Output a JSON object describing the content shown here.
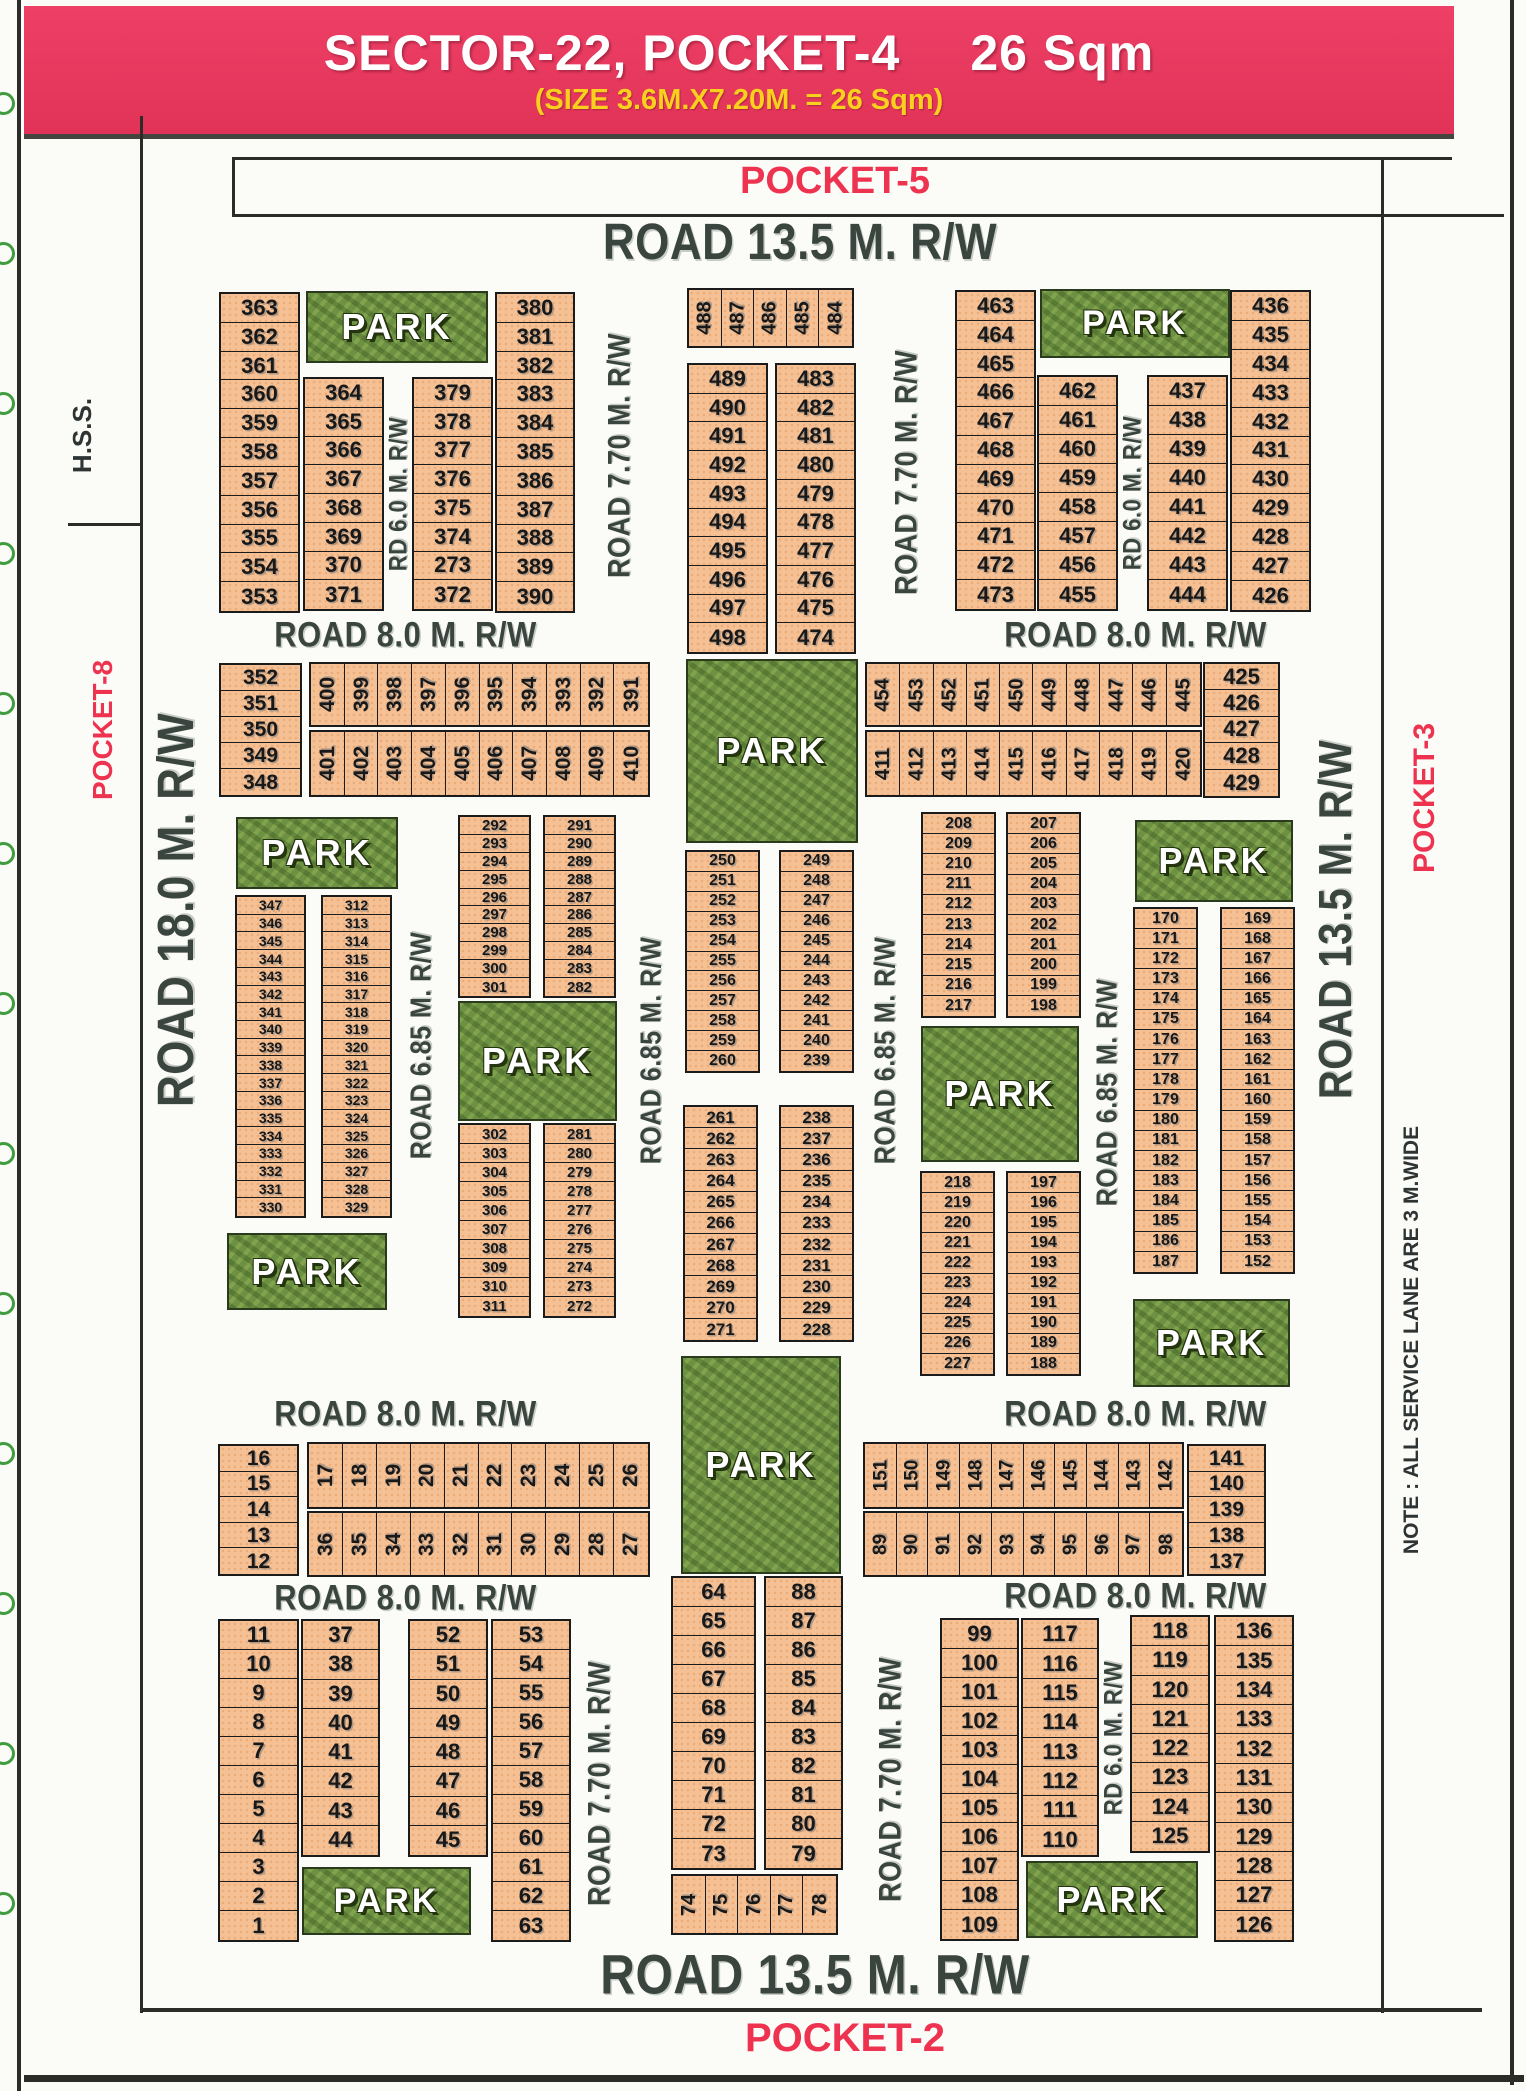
{
  "header": {
    "title_main": "SECTOR-22, POCKET-4",
    "title_area": "26 Sqm",
    "subtitle": "(SIZE 3.6M.X7.20M. = 26 Sqm)"
  },
  "pocket_top": "POCKET-5",
  "pocket_bottom": "POCKET-2",
  "pocket_left": "POCKET-8",
  "pocket_right": "POCKET-3",
  "hss": "H.S.S.",
  "note": "NOTE : ALL SERVICE LANE ARE 3 M.WIDE",
  "park_label": "PARK",
  "colors": {
    "banner": "#e73a5e",
    "banner_text": "#ffffff",
    "subtitle_yellow": "#f8d01d",
    "plot_fill": "#f5c094",
    "park_green": "#6d9142",
    "road_text": "#3a4540",
    "pocket_red": "#ee3350",
    "line_dark": "#2b2b28"
  },
  "binding": {
    "count": 13,
    "start_y": 92,
    "gap": 150
  },
  "road_labels": [
    {
      "text": "ROAD 13.5 M. R/W",
      "x": 540,
      "y": 218,
      "w": 520,
      "h": 50,
      "o": "h",
      "s": 44
    },
    {
      "text": "ROAD 8.0 M. R/W",
      "x": 238,
      "y": 614,
      "w": 335,
      "h": 42,
      "o": "h",
      "s": 31
    },
    {
      "text": "ROAD 8.0 M. R/W",
      "x": 968,
      "y": 614,
      "w": 335,
      "h": 42,
      "o": "h",
      "s": 31
    },
    {
      "text": "ROAD 8.0 M. R/W",
      "x": 238,
      "y": 1394,
      "w": 335,
      "h": 40,
      "o": "h",
      "s": 31
    },
    {
      "text": "ROAD 8.0 M. R/W",
      "x": 968,
      "y": 1394,
      "w": 335,
      "h": 40,
      "o": "h",
      "s": 31
    },
    {
      "text": "ROAD 8.0 M. R/W",
      "x": 238,
      "y": 1578,
      "w": 335,
      "h": 40,
      "o": "h",
      "s": 31
    },
    {
      "text": "ROAD 8.0 M. R/W",
      "x": 968,
      "y": 1576,
      "w": 335,
      "h": 40,
      "o": "h",
      "s": 31
    },
    {
      "text": "ROAD 13.5 M. R/W",
      "x": 530,
      "y": 1944,
      "w": 570,
      "h": 62,
      "o": "h",
      "s": 48
    },
    {
      "text": "ROAD 7.70 M. R/W",
      "x": 597,
      "y": 288,
      "w": 45,
      "h": 335,
      "o": "v",
      "s": 27
    },
    {
      "text": "ROAD 7.70 M. R/W",
      "x": 884,
      "y": 288,
      "w": 45,
      "h": 368,
      "o": "v",
      "s": 27
    },
    {
      "text": "RD 6.0 M. R/W",
      "x": 383,
      "y": 377,
      "w": 30,
      "h": 233,
      "o": "v",
      "s": 22
    },
    {
      "text": "RD 6.0 M. R/W",
      "x": 1117,
      "y": 375,
      "w": 30,
      "h": 236,
      "o": "v",
      "s": 22
    },
    {
      "text": "ROAD 18.0 M. R/W",
      "x": 148,
      "y": 550,
      "w": 58,
      "h": 720,
      "o": "v",
      "s": 44
    },
    {
      "text": "ROAD 6.85 M. R/W",
      "x": 400,
      "y": 893,
      "w": 44,
      "h": 305,
      "o": "v",
      "s": 25
    },
    {
      "text": "ROAD 6.85 M. R/W",
      "x": 630,
      "y": 893,
      "w": 44,
      "h": 315,
      "o": "v",
      "s": 25
    },
    {
      "text": "ROAD 6.85 M. R/W",
      "x": 864,
      "y": 893,
      "w": 44,
      "h": 315,
      "o": "v",
      "s": 25
    },
    {
      "text": "ROAD 6.85 M. R/W",
      "x": 1086,
      "y": 940,
      "w": 44,
      "h": 305,
      "o": "v",
      "s": 25
    },
    {
      "text": "ROAD 13.5 M. R/W",
      "x": 1310,
      "y": 672,
      "w": 54,
      "h": 495,
      "o": "v",
      "s": 40
    },
    {
      "text": "ROAD 7.70 M. R/W",
      "x": 577,
      "y": 1630,
      "w": 45,
      "h": 307,
      "o": "v",
      "s": 27
    },
    {
      "text": "ROAD 7.70 M. R/W",
      "x": 868,
      "y": 1626,
      "w": 45,
      "h": 307,
      "o": "v",
      "s": 27
    },
    {
      "text": "RD 6.0 M. R/W",
      "x": 1099,
      "y": 1619,
      "w": 28,
      "h": 238,
      "o": "v",
      "s": 22
    }
  ],
  "plot_blocks": [
    {
      "x": 219,
      "y": 292,
      "w": 81,
      "h": 321,
      "o": "v",
      "plots": [
        363,
        362,
        361,
        360,
        359,
        358,
        357,
        356,
        355,
        354,
        353
      ]
    },
    {
      "x": 303,
      "y": 377,
      "w": 81,
      "h": 234,
      "o": "v",
      "plots": [
        364,
        365,
        366,
        367,
        368,
        369,
        370,
        371
      ]
    },
    {
      "x": 412,
      "y": 377,
      "w": 81,
      "h": 234,
      "o": "v",
      "plots": [
        379,
        378,
        377,
        376,
        375,
        374,
        273,
        372
      ]
    },
    {
      "x": 495,
      "y": 292,
      "w": 80,
      "h": 321,
      "o": "v",
      "plots": [
        380,
        381,
        382,
        383,
        384,
        385,
        386,
        387,
        388,
        389,
        390
      ]
    },
    {
      "x": 687,
      "y": 288,
      "w": 167,
      "h": 60,
      "o": "h",
      "plots": [
        488,
        487,
        486,
        485,
        484
      ]
    },
    {
      "x": 687,
      "y": 363,
      "w": 81,
      "h": 291,
      "o": "v",
      "plots": [
        489,
        490,
        491,
        492,
        493,
        494,
        495,
        496,
        497,
        498
      ]
    },
    {
      "x": 775,
      "y": 363,
      "w": 81,
      "h": 291,
      "o": "v",
      "plots": [
        483,
        482,
        481,
        480,
        479,
        478,
        477,
        476,
        475,
        474
      ]
    },
    {
      "x": 955,
      "y": 290,
      "w": 81,
      "h": 321,
      "o": "v",
      "plots": [
        463,
        464,
        465,
        466,
        467,
        468,
        469,
        470,
        471,
        472,
        473
      ]
    },
    {
      "x": 1037,
      "y": 375,
      "w": 81,
      "h": 236,
      "o": "v",
      "plots": [
        462,
        461,
        460,
        459,
        458,
        457,
        456,
        455
      ]
    },
    {
      "x": 1147,
      "y": 375,
      "w": 81,
      "h": 236,
      "o": "v",
      "plots": [
        437,
        438,
        439,
        440,
        441,
        442,
        443,
        444
      ]
    },
    {
      "x": 1230,
      "y": 290,
      "w": 81,
      "h": 322,
      "o": "v",
      "plots": [
        436,
        435,
        434,
        433,
        432,
        431,
        430,
        429,
        428,
        427,
        426
      ]
    },
    {
      "x": 219,
      "y": 663,
      "w": 83,
      "h": 134,
      "o": "v",
      "plots": [
        352,
        351,
        350,
        349,
        348
      ]
    },
    {
      "x": 309,
      "y": 662,
      "w": 341,
      "h": 65,
      "o": "h",
      "plots": [
        400,
        399,
        398,
        397,
        396,
        395,
        394,
        393,
        392,
        391
      ]
    },
    {
      "x": 309,
      "y": 730,
      "w": 341,
      "h": 67,
      "o": "h",
      "plots": [
        401,
        402,
        403,
        404,
        405,
        406,
        407,
        408,
        409,
        410
      ]
    },
    {
      "x": 865,
      "y": 662,
      "w": 337,
      "h": 65,
      "o": "h",
      "plots": [
        454,
        453,
        452,
        451,
        450,
        449,
        448,
        447,
        446,
        445
      ]
    },
    {
      "x": 865,
      "y": 730,
      "w": 337,
      "h": 67,
      "o": "h",
      "plots": [
        411,
        412,
        413,
        414,
        415,
        416,
        417,
        418,
        419,
        420
      ]
    },
    {
      "x": 1203,
      "y": 662,
      "w": 77,
      "h": 136,
      "o": "v",
      "plots": [
        425,
        426,
        427,
        428,
        429
      ]
    },
    {
      "x": 235,
      "y": 895,
      "w": 71,
      "h": 323,
      "o": "v",
      "plots": [
        347,
        346,
        345,
        344,
        343,
        342,
        341,
        340,
        339,
        338,
        337,
        336,
        335,
        334,
        333,
        332,
        331,
        330
      ]
    },
    {
      "x": 321,
      "y": 895,
      "w": 71,
      "h": 323,
      "o": "v",
      "plots": [
        312,
        313,
        314,
        315,
        316,
        317,
        318,
        319,
        320,
        321,
        322,
        323,
        324,
        325,
        326,
        327,
        328,
        329
      ]
    },
    {
      "x": 458,
      "y": 815,
      "w": 73,
      "h": 183,
      "o": "v",
      "plots": [
        292,
        293,
        294,
        295,
        296,
        297,
        298,
        299,
        300,
        301
      ]
    },
    {
      "x": 543,
      "y": 815,
      "w": 73,
      "h": 183,
      "o": "v",
      "plots": [
        291,
        290,
        289,
        288,
        287,
        286,
        285,
        284,
        283,
        282
      ]
    },
    {
      "x": 458,
      "y": 1123,
      "w": 73,
      "h": 195,
      "o": "v",
      "plots": [
        302,
        303,
        304,
        305,
        306,
        307,
        308,
        309,
        310,
        311
      ]
    },
    {
      "x": 543,
      "y": 1123,
      "w": 73,
      "h": 195,
      "o": "v",
      "plots": [
        281,
        280,
        279,
        278,
        277,
        276,
        275,
        274,
        273,
        272
      ]
    },
    {
      "x": 685,
      "y": 850,
      "w": 75,
      "h": 223,
      "o": "v",
      "plots": [
        250,
        251,
        252,
        253,
        254,
        255,
        256,
        257,
        258,
        259,
        260
      ]
    },
    {
      "x": 779,
      "y": 850,
      "w": 75,
      "h": 223,
      "o": "v",
      "plots": [
        249,
        248,
        247,
        246,
        245,
        244,
        243,
        242,
        241,
        240,
        239
      ]
    },
    {
      "x": 683,
      "y": 1105,
      "w": 75,
      "h": 237,
      "o": "v",
      "plots": [
        261,
        262,
        263,
        264,
        265,
        266,
        267,
        268,
        269,
        270,
        271
      ]
    },
    {
      "x": 779,
      "y": 1105,
      "w": 75,
      "h": 237,
      "o": "v",
      "plots": [
        238,
        237,
        236,
        235,
        234,
        233,
        232,
        231,
        230,
        229,
        228
      ]
    },
    {
      "x": 921,
      "y": 812,
      "w": 75,
      "h": 206,
      "o": "v",
      "plots": [
        208,
        209,
        210,
        211,
        212,
        213,
        214,
        215,
        216,
        217
      ]
    },
    {
      "x": 1006,
      "y": 812,
      "w": 75,
      "h": 206,
      "o": "v",
      "plots": [
        207,
        206,
        205,
        204,
        203,
        202,
        201,
        200,
        199,
        198
      ]
    },
    {
      "x": 920,
      "y": 1171,
      "w": 75,
      "h": 205,
      "o": "v",
      "plots": [
        218,
        219,
        220,
        221,
        222,
        223,
        224,
        225,
        226,
        227
      ]
    },
    {
      "x": 1006,
      "y": 1171,
      "w": 75,
      "h": 205,
      "o": "v",
      "plots": [
        197,
        196,
        195,
        194,
        193,
        192,
        191,
        190,
        189,
        188
      ]
    },
    {
      "x": 1133,
      "y": 907,
      "w": 65,
      "h": 367,
      "o": "v",
      "plots": [
        170,
        171,
        172,
        173,
        174,
        175,
        176,
        177,
        178,
        179,
        180,
        181,
        182,
        183,
        184,
        185,
        186,
        187
      ]
    },
    {
      "x": 1220,
      "y": 907,
      "w": 75,
      "h": 367,
      "o": "v",
      "plots": [
        169,
        168,
        167,
        166,
        165,
        164,
        163,
        162,
        161,
        160,
        159,
        158,
        157,
        156,
        155,
        154,
        153,
        152
      ]
    },
    {
      "x": 218,
      "y": 1444,
      "w": 81,
      "h": 132,
      "o": "v",
      "plots": [
        16,
        15,
        14,
        13,
        12
      ]
    },
    {
      "x": 307,
      "y": 1442,
      "w": 343,
      "h": 67,
      "o": "h",
      "plots": [
        17,
        18,
        19,
        20,
        21,
        22,
        23,
        24,
        25,
        26
      ]
    },
    {
      "x": 307,
      "y": 1511,
      "w": 343,
      "h": 66,
      "o": "h",
      "plots": [
        36,
        35,
        34,
        33,
        32,
        31,
        30,
        29,
        28,
        27
      ]
    },
    {
      "x": 863,
      "y": 1442,
      "w": 321,
      "h": 67,
      "o": "h",
      "plots": [
        151,
        150,
        149,
        148,
        147,
        146,
        145,
        144,
        143,
        142
      ]
    },
    {
      "x": 863,
      "y": 1511,
      "w": 321,
      "h": 66,
      "o": "h",
      "plots": [
        89,
        90,
        91,
        92,
        93,
        94,
        95,
        96,
        97,
        98
      ]
    },
    {
      "x": 1187,
      "y": 1444,
      "w": 79,
      "h": 132,
      "o": "v",
      "plots": [
        141,
        140,
        139,
        138,
        137
      ]
    },
    {
      "x": 218,
      "y": 1619,
      "w": 81,
      "h": 323,
      "o": "v",
      "plots": [
        11,
        10,
        9,
        8,
        7,
        6,
        5,
        4,
        3,
        2,
        1
      ]
    },
    {
      "x": 301,
      "y": 1619,
      "w": 79,
      "h": 238,
      "o": "v",
      "plots": [
        37,
        38,
        39,
        40,
        41,
        42,
        43,
        44
      ]
    },
    {
      "x": 408,
      "y": 1619,
      "w": 80,
      "h": 238,
      "o": "v",
      "plots": [
        52,
        51,
        50,
        49,
        48,
        47,
        46,
        45
      ]
    },
    {
      "x": 491,
      "y": 1619,
      "w": 80,
      "h": 323,
      "o": "v",
      "plots": [
        53,
        54,
        55,
        56,
        57,
        58,
        59,
        60,
        61,
        62,
        63
      ]
    },
    {
      "x": 671,
      "y": 1576,
      "w": 85,
      "h": 294,
      "o": "v",
      "plots": [
        64,
        65,
        66,
        67,
        68,
        69,
        70,
        71,
        72,
        73
      ]
    },
    {
      "x": 764,
      "y": 1576,
      "w": 79,
      "h": 294,
      "o": "v",
      "plots": [
        88,
        87,
        86,
        85,
        84,
        83,
        82,
        81,
        80,
        79
      ]
    },
    {
      "x": 671,
      "y": 1874,
      "w": 167,
      "h": 61,
      "o": "h",
      "plots": [
        74,
        75,
        76,
        77,
        78
      ]
    },
    {
      "x": 940,
      "y": 1618,
      "w": 79,
      "h": 323,
      "o": "v",
      "plots": [
        99,
        100,
        101,
        102,
        103,
        104,
        105,
        106,
        107,
        108,
        109
      ]
    },
    {
      "x": 1021,
      "y": 1618,
      "w": 78,
      "h": 239,
      "o": "v",
      "plots": [
        117,
        116,
        115,
        114,
        113,
        112,
        111,
        110
      ]
    },
    {
      "x": 1130,
      "y": 1615,
      "w": 80,
      "h": 238,
      "o": "v",
      "plots": [
        118,
        119,
        120,
        121,
        122,
        123,
        124,
        125
      ]
    },
    {
      "x": 1214,
      "y": 1615,
      "w": 80,
      "h": 327,
      "o": "v",
      "plots": [
        136,
        135,
        134,
        133,
        132,
        131,
        130,
        129,
        128,
        127,
        126
      ]
    }
  ],
  "parks": [
    {
      "x": 306,
      "y": 291,
      "w": 182,
      "h": 72
    },
    {
      "x": 1040,
      "y": 289,
      "w": 190,
      "h": 69
    },
    {
      "x": 686,
      "y": 659,
      "w": 172,
      "h": 184
    },
    {
      "x": 236,
      "y": 817,
      "w": 162,
      "h": 72
    },
    {
      "x": 227,
      "y": 1233,
      "w": 160,
      "h": 77
    },
    {
      "x": 458,
      "y": 1001,
      "w": 159,
      "h": 120
    },
    {
      "x": 681,
      "y": 1356,
      "w": 160,
      "h": 218
    },
    {
      "x": 1135,
      "y": 820,
      "w": 158,
      "h": 82
    },
    {
      "x": 921,
      "y": 1026,
      "w": 158,
      "h": 136
    },
    {
      "x": 1133,
      "y": 1299,
      "w": 157,
      "h": 88
    },
    {
      "x": 302,
      "y": 1867,
      "w": 169,
      "h": 68
    },
    {
      "x": 1026,
      "y": 1861,
      "w": 172,
      "h": 77
    }
  ],
  "lines": [
    {
      "x": 17,
      "y": 0,
      "w": 4,
      "h": 2091
    },
    {
      "x": 140,
      "y": 116,
      "w": 3,
      "h": 1897
    },
    {
      "x": 1381,
      "y": 157,
      "w": 3,
      "h": 1856
    },
    {
      "x": 1510,
      "y": 0,
      "w": 4,
      "h": 2085
    },
    {
      "x": 232,
      "y": 157,
      "w": 1220,
      "h": 3
    },
    {
      "x": 232,
      "y": 214,
      "w": 1272,
      "h": 3
    },
    {
      "x": 232,
      "y": 157,
      "w": 3,
      "h": 60
    },
    {
      "x": 68,
      "y": 523,
      "w": 74,
      "h": 3
    },
    {
      "x": 140,
      "y": 2008,
      "w": 1342,
      "h": 4
    },
    {
      "x": 24,
      "y": 2075,
      "w": 1500,
      "h": 7
    }
  ]
}
